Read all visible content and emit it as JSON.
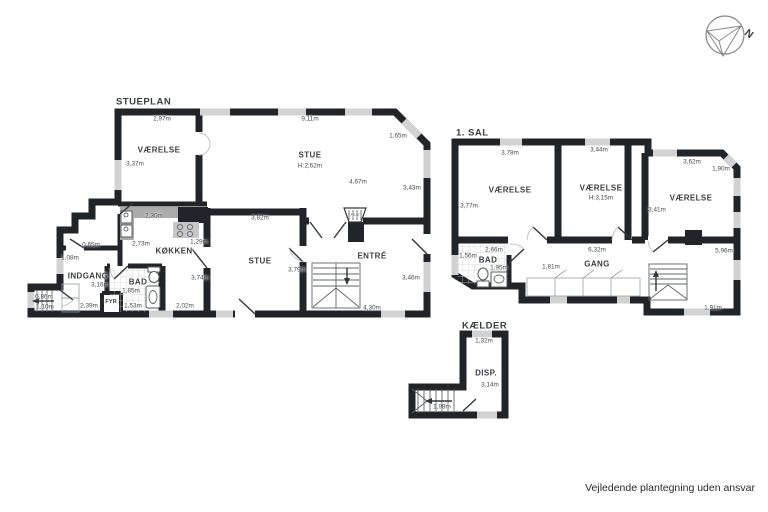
{
  "colors": {
    "wall": "#212428",
    "window": "#d2d2d2",
    "counter": "#ababab",
    "background": "#ffffff"
  },
  "compass": {
    "label": "N"
  },
  "footer": {
    "disclaimer": "Vejledende plantegning uden ansvar"
  },
  "floors": [
    {
      "id": "stueplan",
      "heading": {
        "text": "STUEPLAN",
        "x": 116,
        "y": 102
      },
      "labels": [
        {
          "text": "VÆRELSE",
          "x": 159,
          "y": 150,
          "kind": "room"
        },
        {
          "text": "STUE",
          "x": 310,
          "y": 155,
          "kind": "room"
        },
        {
          "text": "KØKKEN",
          "x": 174,
          "y": 251,
          "kind": "room"
        },
        {
          "text": "STUE",
          "x": 260,
          "y": 261,
          "kind": "room"
        },
        {
          "text": "ENTRÉ",
          "x": 372,
          "y": 256,
          "kind": "room"
        },
        {
          "text": "INDGANG",
          "x": 88,
          "y": 276,
          "kind": "room"
        },
        {
          "text": "BAD",
          "x": 138,
          "y": 282,
          "kind": "room"
        },
        {
          "text": "FYR",
          "x": 111,
          "y": 302,
          "kind": "small"
        },
        {
          "text": "PEJS",
          "x": 355,
          "y": 215,
          "kind": "tiny"
        },
        {
          "text": "2,97m",
          "x": 162,
          "y": 119,
          "kind": "dim"
        },
        {
          "text": "9,11m",
          "x": 310,
          "y": 119,
          "kind": "dim"
        },
        {
          "text": "1,65m",
          "x": 398,
          "y": 136,
          "kind": "dim"
        },
        {
          "text": "3,37m",
          "x": 135,
          "y": 164,
          "kind": "dim"
        },
        {
          "text": "H:2,62m",
          "x": 310,
          "y": 166,
          "kind": "dim"
        },
        {
          "text": "4,67m",
          "x": 358,
          "y": 182,
          "kind": "dim"
        },
        {
          "text": "3,43m",
          "x": 412,
          "y": 188,
          "kind": "dim"
        },
        {
          "text": "2,30m",
          "x": 154,
          "y": 216,
          "kind": "dim"
        },
        {
          "text": "3,82m",
          "x": 260,
          "y": 218,
          "kind": "dim"
        },
        {
          "text": "1,29m",
          "x": 199,
          "y": 242,
          "kind": "dim"
        },
        {
          "text": "2,73m",
          "x": 141,
          "y": 244,
          "kind": "dim"
        },
        {
          "text": "0,65m",
          "x": 91,
          "y": 245,
          "kind": "dim"
        },
        {
          "text": "1,08m",
          "x": 70,
          "y": 258,
          "kind": "dim"
        },
        {
          "text": "3,79m",
          "x": 297,
          "y": 270,
          "kind": "dim"
        },
        {
          "text": "3,74m",
          "x": 200,
          "y": 278,
          "kind": "dim"
        },
        {
          "text": "3,46m",
          "x": 411,
          "y": 278,
          "kind": "dim"
        },
        {
          "text": "3,16m",
          "x": 100,
          "y": 285,
          "kind": "dim"
        },
        {
          "text": "1,85m",
          "x": 131,
          "y": 291,
          "kind": "dim"
        },
        {
          "text": "0,86m",
          "x": 44,
          "y": 297,
          "kind": "dim"
        },
        {
          "text": "2,39m",
          "x": 89,
          "y": 306,
          "kind": "dim"
        },
        {
          "text": "1,53m",
          "x": 133,
          "y": 306,
          "kind": "dim"
        },
        {
          "text": "2,02m",
          "x": 185,
          "y": 306,
          "kind": "dim"
        },
        {
          "text": "1,10m",
          "x": 45,
          "y": 307,
          "kind": "dim"
        },
        {
          "text": "4,30m",
          "x": 372,
          "y": 308,
          "kind": "dim"
        }
      ]
    },
    {
      "id": "1-sal",
      "heading": {
        "text": "1. SAL",
        "x": 456,
        "y": 133
      },
      "labels": [
        {
          "text": "VÆRELSE",
          "x": 510,
          "y": 190,
          "kind": "room"
        },
        {
          "text": "VÆRELSE",
          "x": 601,
          "y": 188,
          "kind": "room"
        },
        {
          "text": "VÆRELSE",
          "x": 691,
          "y": 198,
          "kind": "room"
        },
        {
          "text": "BAD",
          "x": 488,
          "y": 260,
          "kind": "room"
        },
        {
          "text": "GANG",
          "x": 597,
          "y": 264,
          "kind": "room"
        },
        {
          "text": "3,78m",
          "x": 510,
          "y": 153,
          "kind": "dim"
        },
        {
          "text": "3,44m",
          "x": 599,
          "y": 150,
          "kind": "dim"
        },
        {
          "text": "3,62m",
          "x": 692,
          "y": 162,
          "kind": "dim"
        },
        {
          "text": "1,90m",
          "x": 721,
          "y": 169,
          "kind": "dim"
        },
        {
          "text": "H:3,15m",
          "x": 601,
          "y": 198,
          "kind": "dim"
        },
        {
          "text": "3,77m",
          "x": 469,
          "y": 206,
          "kind": "dim"
        },
        {
          "text": "3,41m",
          "x": 657,
          "y": 210,
          "kind": "dim"
        },
        {
          "text": "2,66m",
          "x": 494,
          "y": 250,
          "kind": "dim"
        },
        {
          "text": "6,32m",
          "x": 597,
          "y": 250,
          "kind": "dim"
        },
        {
          "text": "5,96m",
          "x": 724,
          "y": 251,
          "kind": "dim"
        },
        {
          "text": "1,56m",
          "x": 468,
          "y": 256,
          "kind": "dim"
        },
        {
          "text": "1,95m",
          "x": 499,
          "y": 268,
          "kind": "dim"
        },
        {
          "text": "1,81m",
          "x": 551,
          "y": 267,
          "kind": "dim"
        },
        {
          "text": "1,91m",
          "x": 713,
          "y": 308,
          "kind": "dim"
        }
      ]
    },
    {
      "id": "kaelder",
      "heading": {
        "text": "KÆLDER",
        "x": 462,
        "y": 326
      },
      "labels": [
        {
          "text": "DISP.",
          "x": 486,
          "y": 373,
          "kind": "room"
        },
        {
          "text": "1,32m",
          "x": 484,
          "y": 341,
          "kind": "dim"
        },
        {
          "text": "3,14m",
          "x": 490,
          "y": 385,
          "kind": "dim"
        },
        {
          "text": "1,98m",
          "x": 442,
          "y": 407,
          "kind": "dim"
        }
      ]
    }
  ]
}
